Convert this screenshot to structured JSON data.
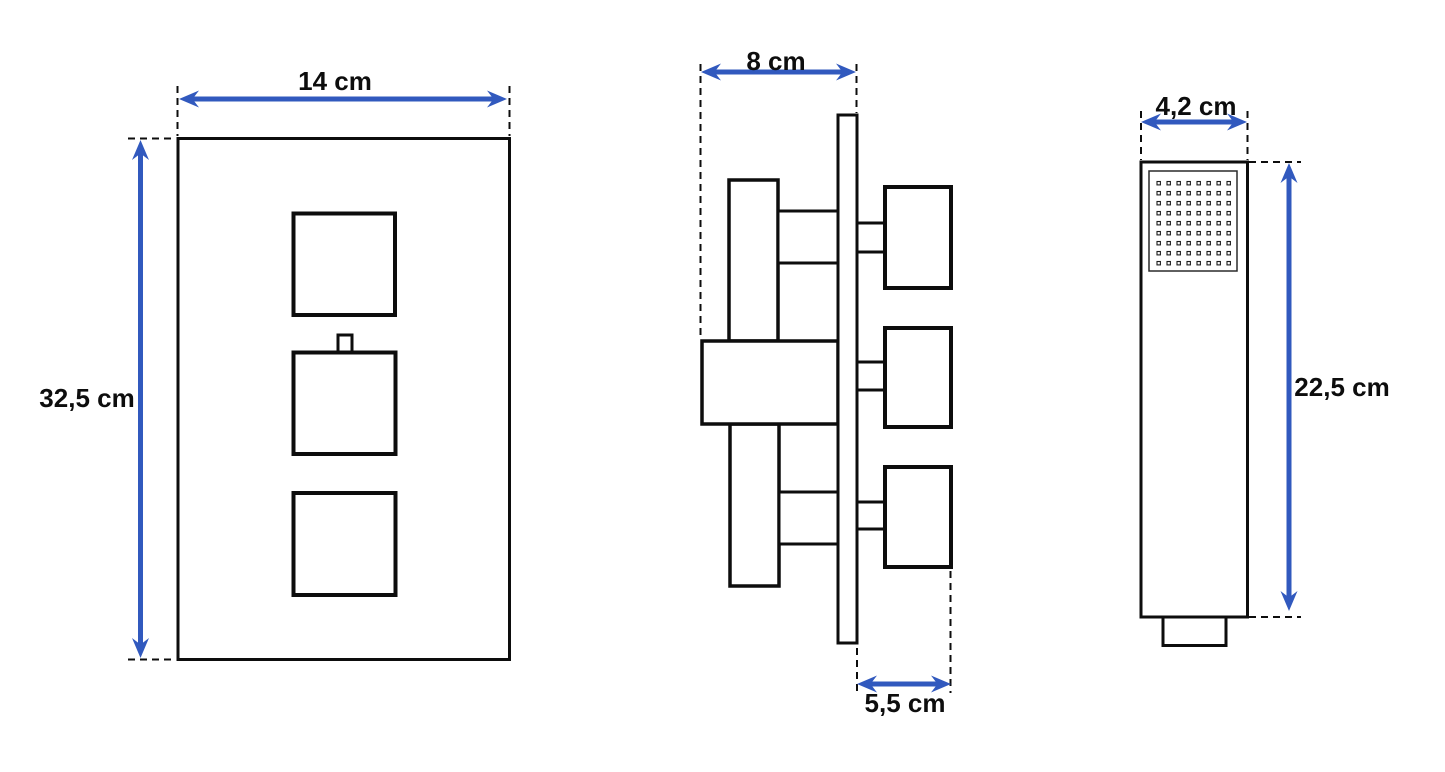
{
  "drawing": {
    "views": {
      "front_panel": {
        "name": "mixer front view",
        "width_label": "14 cm",
        "height_label": "32,5 cm"
      },
      "side_profile": {
        "name": "mixer side view",
        "depth_label": "8 cm",
        "handle_depth_label": "5,5 cm"
      },
      "hand_shower": {
        "name": "hand shower view",
        "width_label": "4,2 cm",
        "height_label": "22,5 cm",
        "spray_nozzle_grid": {
          "columns": 8,
          "rows": 9
        }
      }
    },
    "colors": {
      "dimension_blue": "#3159BE",
      "line_black": "#0d0d0d",
      "background": "#ffffff"
    }
  }
}
